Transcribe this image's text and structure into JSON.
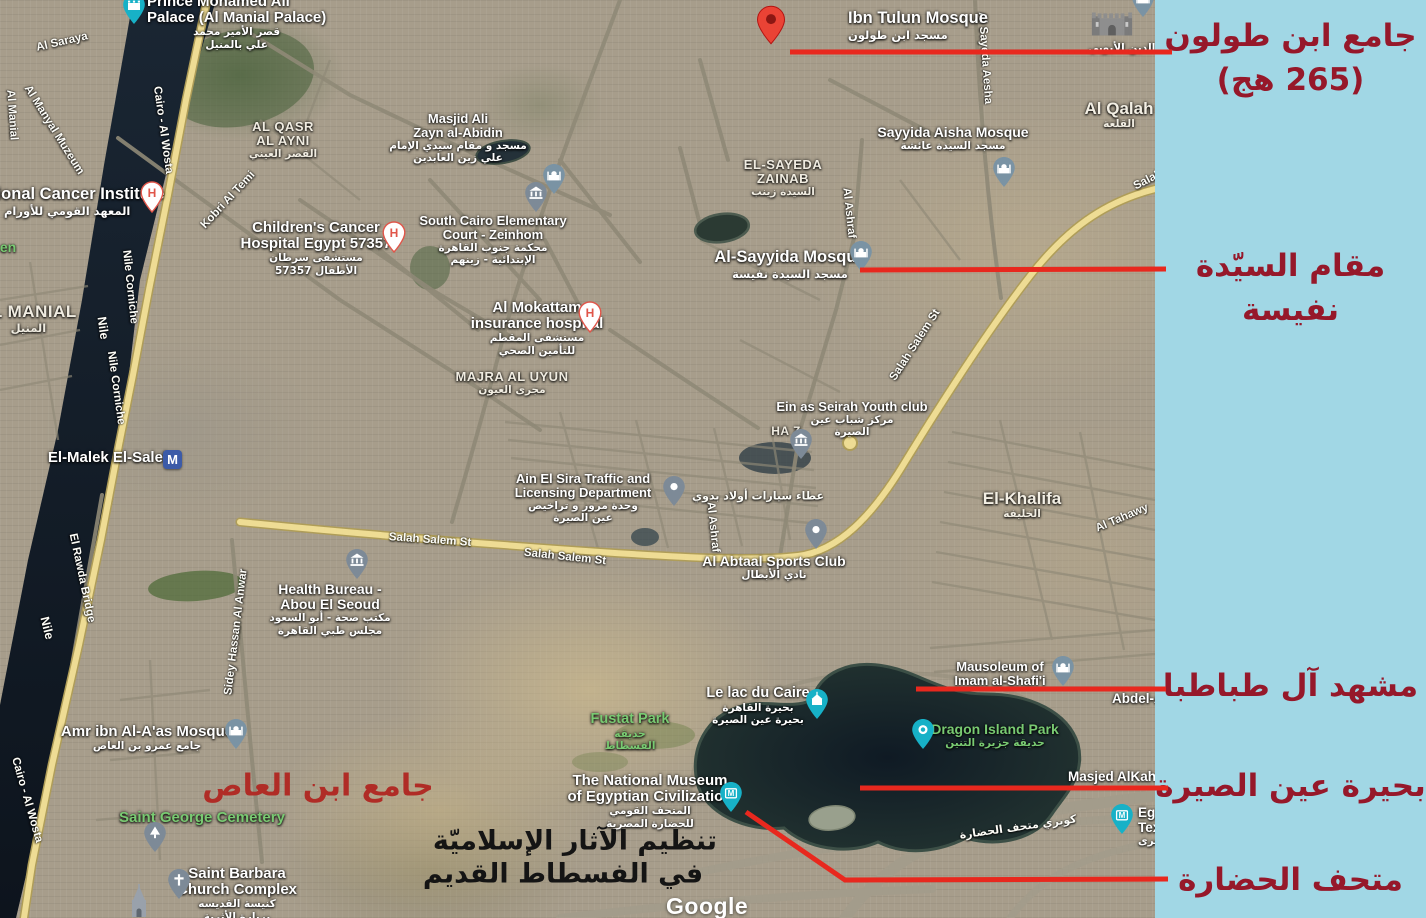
{
  "colors": {
    "panel_bg": "#a1d7e5",
    "annotation_text": "#96182a",
    "annotation_line": "#e8281e",
    "map_red_text": "#b02c26",
    "park_label": "#79ca72",
    "nile_water": "#16202c",
    "lake_water": "#17232b"
  },
  "panel": {
    "annotations": [
      {
        "lines": [
          "جامع ابن طولون",
          "(265 هج)"
        ]
      },
      {
        "lines": [
          "مقام السيّدة نفيسة"
        ]
      },
      {
        "lines": [
          "مشهد آل طباطبا"
        ]
      },
      {
        "lines": [
          "بحيرة عين الصيرة"
        ]
      },
      {
        "lines": [
          "متحف الحضارة"
        ]
      }
    ]
  },
  "map": {
    "attribution": "Google",
    "overlay": {
      "red_text": "جامع ابن العاص",
      "black_line1": "تنظيم الآثار الإسلاميّة",
      "black_line2": "في الفسطاط القديم"
    },
    "fragments": [
      "en",
      "S"
    ],
    "areas": [
      {
        "en": "AL QASR",
        "en2": "AL AYNI",
        "ar": "القصر العيني"
      },
      {
        "en": "EL-SAYEDA",
        "en2": "ZAINAB",
        "ar": "السيدة زينب"
      },
      {
        "en": "EL MANIAL",
        "ar": "المنيل"
      },
      {
        "en": "MAJRA AL UYUN",
        "ar": "مجرى العيون"
      },
      {
        "en": "Al Qalah",
        "ar": "القلعة"
      },
      {
        "en": "El-Khalifa",
        "ar": "الخليفة"
      },
      {
        "en": "HA Z"
      }
    ],
    "streets": [
      "Al Saraya",
      "Al Manial",
      "Al Manyal Muzeum",
      "Cairo - Al Wosta",
      "Kobri Al Temi",
      "Nile Corniche",
      "Nile Corniche",
      "Nile",
      "Nile",
      "El Rawda Bridge",
      "Cairo - Al Wosta",
      "Salah Salem St",
      "Salah Salem St",
      "Salah Salem St",
      "Salah",
      "Al Ashraf",
      "Al Ashraf",
      "Al Sayeda Aesha",
      "Sidey Hassan Al Anwar",
      "Al Tahawy",
      "كوبري متحف الحضارة",
      "عطاء سيارات أولاد بدوي"
    ],
    "pois": [
      {
        "en1": "Prince Mohamed Ali",
        "en2": "Palace (Al Manial Palace)",
        "ar1": "قصر الأمير محمد",
        "ar2": "علي بالمنيل",
        "icon": "palace"
      },
      {
        "en1": "Ibn Tulun Mosque",
        "ar1": "مسجد ابن طولون",
        "icon": "red-pin"
      },
      {
        "en1": "Masjid Ali",
        "en2": "Zayn al-Abidin",
        "ar1": "مسجد و مقام سيدي الإمام",
        "ar2": "علي زين العابدين",
        "icon": "mosque"
      },
      {
        "en1": "South Cairo Elementary",
        "en2": "Court - Zeinhom",
        "ar1": "محكمة جنوب القاهرة",
        "ar2": "الإبتدائية - زينهم",
        "icon": "bank"
      },
      {
        "en1": "Sayyida Aisha Mosque",
        "ar1": "مسجد السيدة عائشة",
        "icon": "mosque"
      },
      {
        "en1": "Al-Sayyida Mosque",
        "ar1": "مسجد السيدة نفيسة",
        "icon": "mosque"
      },
      {
        "en1": "National Cancer Institute",
        "ar1": "المعهد القومي للأورام",
        "icon": "hospital"
      },
      {
        "en1": "Children's Cancer",
        "en2": "Hospital Egypt 57357",
        "ar1": "مستشفى سرطان",
        "ar2": "الأطفال 57357",
        "icon": "hospital"
      },
      {
        "en1": "Al Mokattam",
        "en2": "insurance hospital",
        "ar1": "مستشفى المقطم",
        "ar2": "للتأمين الصحي",
        "icon": "hospital"
      },
      {
        "en1": "Ein as Seirah Youth club",
        "ar1": "مركز شباب عين",
        "ar2": "الصيرة",
        "icon": "bank"
      },
      {
        "en1": "Ain El Sira Traffic and",
        "en2": "Licensing Department",
        "ar1": "وحدة مرور و تراخيص",
        "ar2": "عين الصيرة",
        "icon": "dot"
      },
      {
        "en1": "Al Abtaal Sports Club",
        "ar1": "نادي الأبطال",
        "icon": "dot"
      },
      {
        "en1": "Health Bureau -",
        "en2": "Abou El Seoud",
        "ar1": "مكتب صحة - أبو السعود",
        "ar2": "مجلس طبي القاهرة",
        "icon": "bank"
      },
      {
        "en1": "Amr ibn Al-A'as Mosque",
        "ar1": "جامع عمرو بن العاص",
        "icon": "mosque"
      },
      {
        "en1": "Mausoleum of",
        "en2": "Imam al-Shafi'i",
        "icon": "mosque"
      },
      {
        "en1": "Dragon Island Park",
        "ar1": "حديقة جزيرة التنين",
        "icon": "dragon"
      },
      {
        "en1": "Le lac du Caire",
        "ar1": "بحيرة القاهرة",
        "ar2": "بحيرة عين الصيرة",
        "icon": "lake"
      },
      {
        "en1": "Fustat Park",
        "ar1": "حديقة",
        "ar2": "الفسطاط"
      },
      {
        "en1": "The National Museum",
        "en2": "of Egyptian Civilization",
        "ar1": "المتحف القومي",
        "ar2": "للحضارة المصرية",
        "icon": "museum"
      },
      {
        "en1": "Saint George Cemetery",
        "icon": "tree"
      },
      {
        "en1": "Saint Barbara",
        "en2": "Church Complex",
        "ar1": "كنيسة القديسه",
        "ar2": "بربارة الأثرية",
        "icon": "church"
      },
      {
        "en1": "El-Malek El-Saleh",
        "icon": "metro"
      },
      {
        "en1": "Masjed AlKah"
      },
      {
        "en1": "Abdel-A"
      },
      {
        "en1": "Egy",
        "en2": "Tex",
        "ar1": "صرى",
        "icon": "museum"
      },
      {
        "ar1": "قلعة صلاح الدين الأيوبي",
        "icon": "castle"
      }
    ]
  }
}
